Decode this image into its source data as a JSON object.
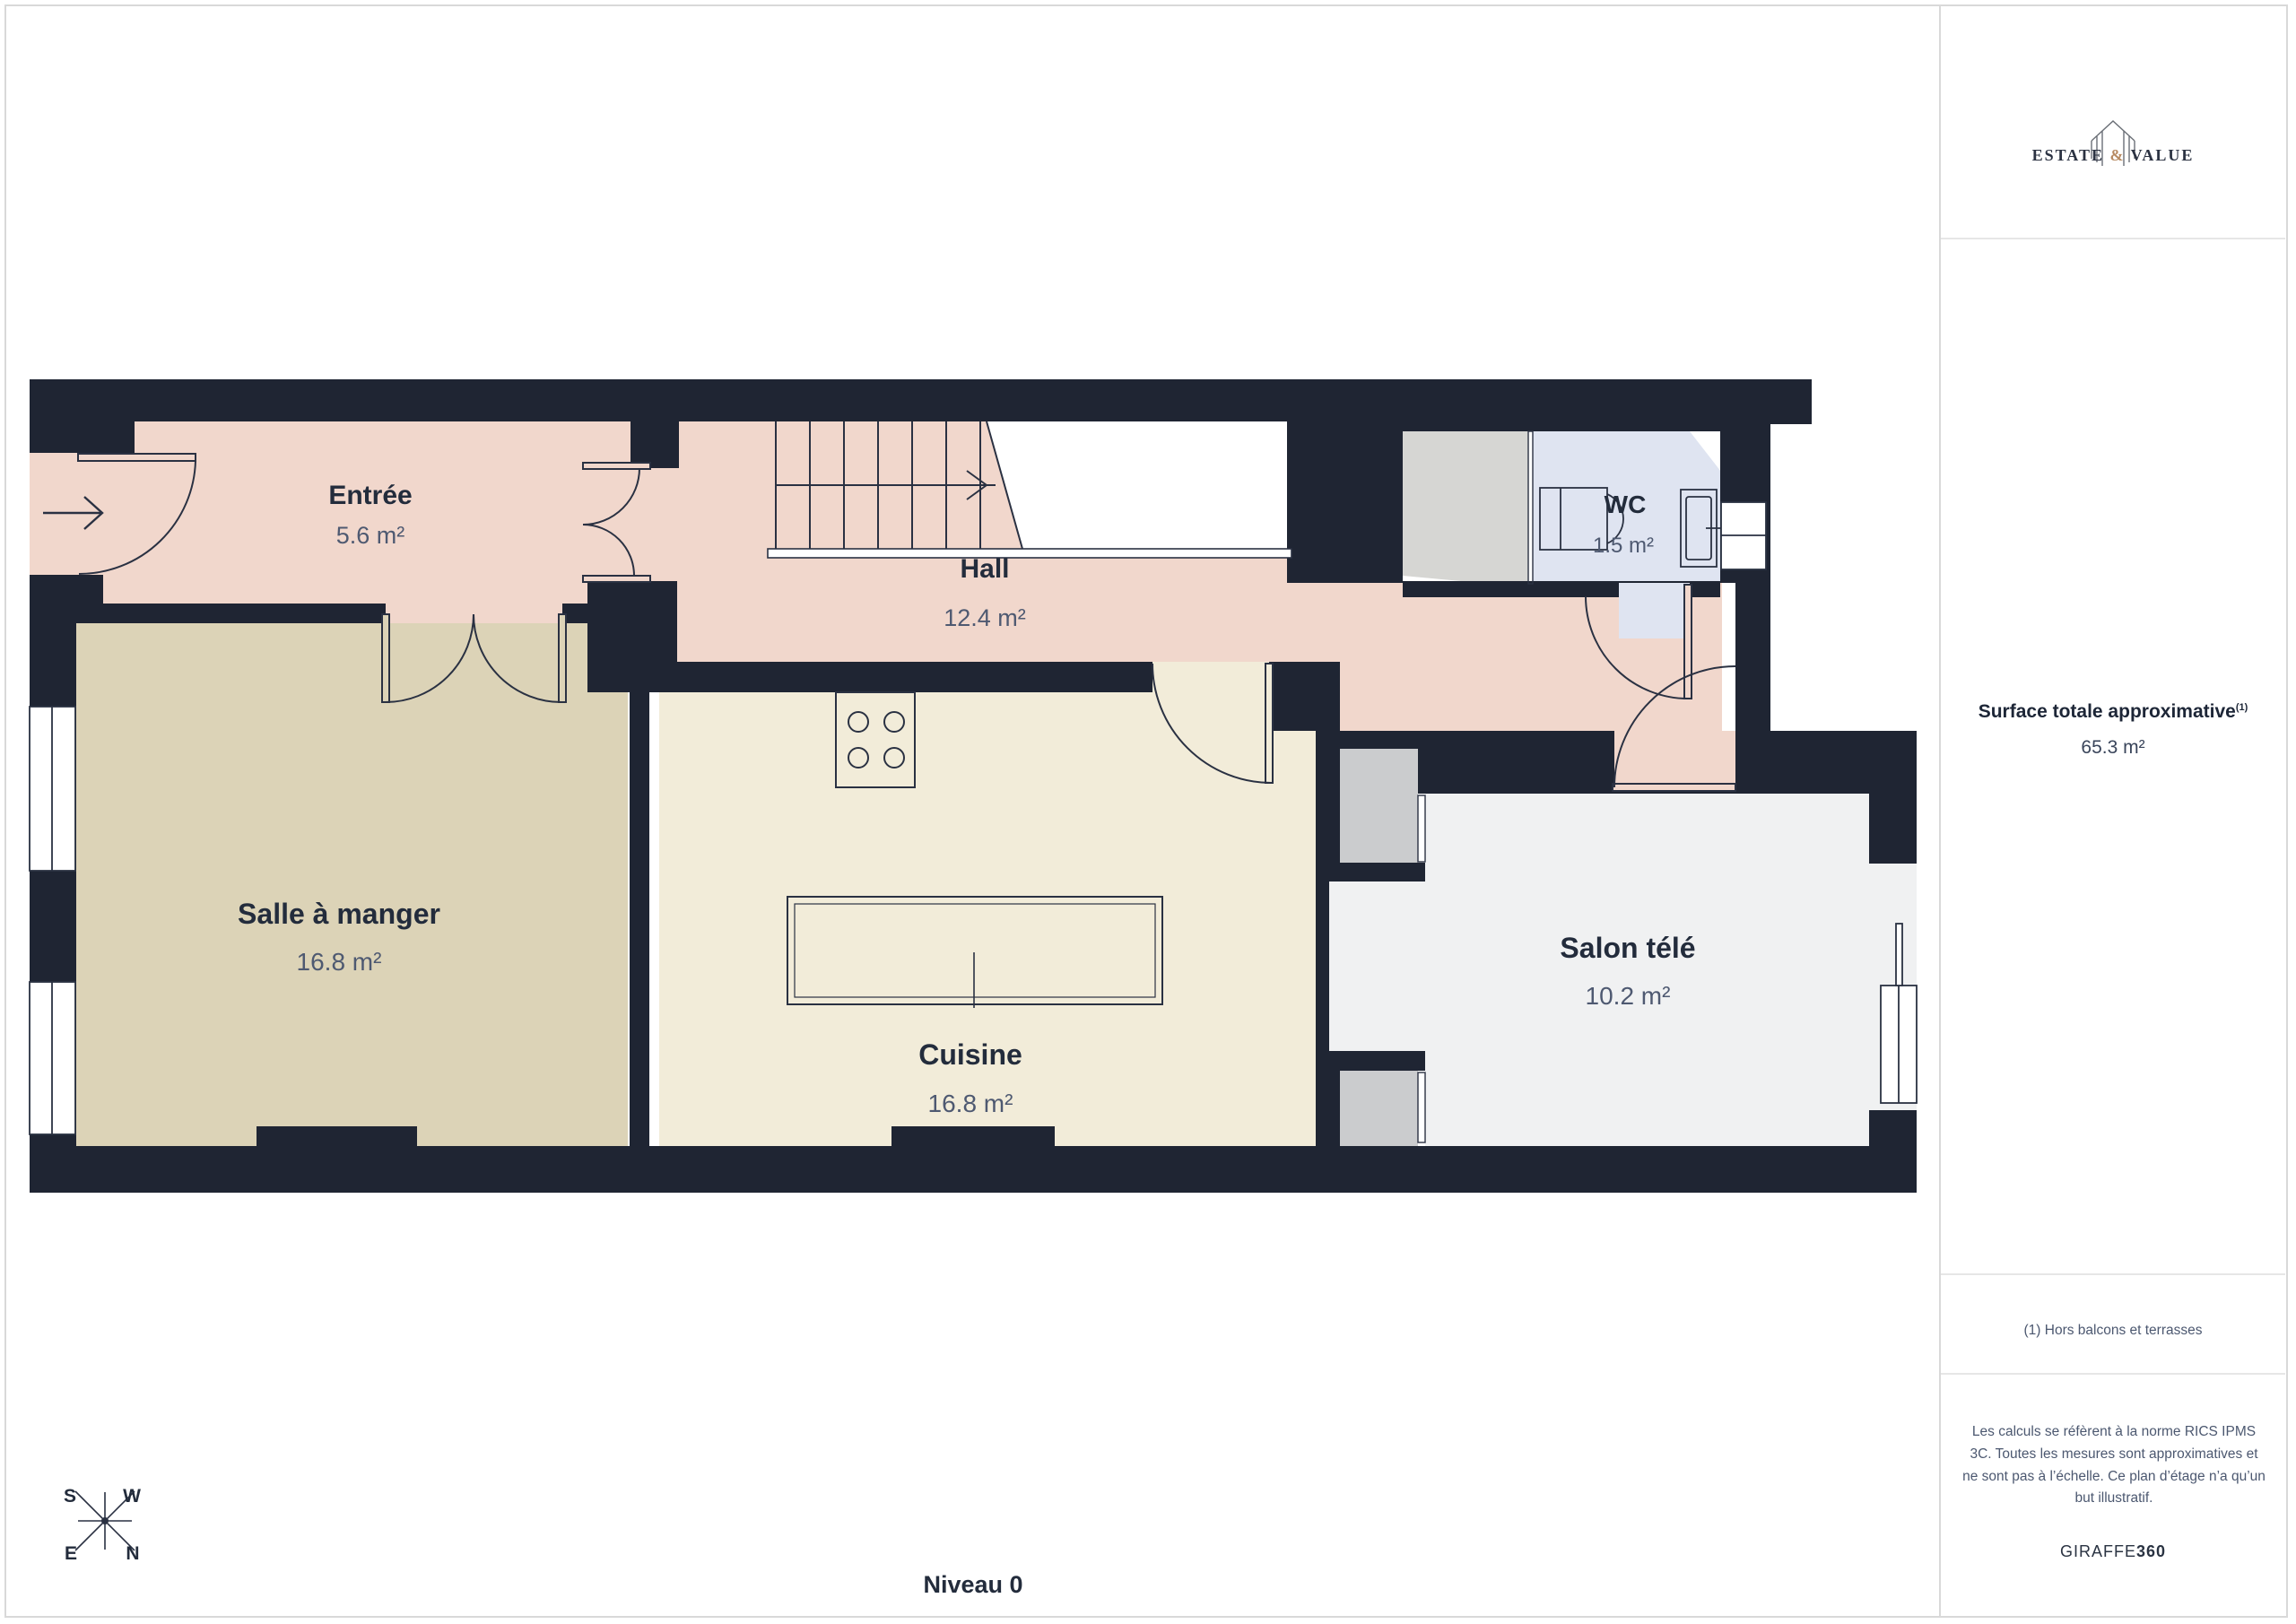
{
  "page": {
    "level_label": "Niveau 0"
  },
  "plan": {
    "rooms": [
      {
        "id": "entree",
        "name": "Entrée",
        "area": "5.6 m²"
      },
      {
        "id": "hall",
        "name": "Hall",
        "area": "12.4 m²"
      },
      {
        "id": "wc",
        "name": "WC",
        "area": "1.5 m²"
      },
      {
        "id": "salle-a-manger",
        "name": "Salle à manger",
        "area": "16.8 m²"
      },
      {
        "id": "cuisine",
        "name": "Cuisine",
        "area": "16.8 m²"
      },
      {
        "id": "salon-tele",
        "name": "Salon télé",
        "area": "10.2 m²"
      }
    ]
  },
  "compass": {
    "n": "N",
    "s": "S",
    "e": "E",
    "w": "W"
  },
  "sidebar": {
    "brand": {
      "name_left": "ESTATE",
      "amp": "&",
      "name_right": "VALUE"
    },
    "surface": {
      "title": "Surface totale approximative",
      "superscript": "(1)",
      "value": "65.3 m²"
    },
    "footnote": "(1) Hors balcons et terrasses",
    "disclaimer": "Les calculs se réfèrent à la norme RICS IPMS 3C. Toutes les mesures sont approximatives et ne sont pas à l’échelle. Ce plan d’étage n’a qu’un but illustratif.",
    "vendor": {
      "name": "GIRAFFE",
      "suffix": "360"
    }
  },
  "colors": {
    "wall": "#1f2533",
    "line": "#2a3142",
    "floor_entree_hall": "#f1d7cc",
    "floor_salle": "#dcd3b7",
    "floor_cuisine": "#f2ecd9",
    "floor_salon": "#f0f1f2",
    "floor_wc": "#dfe4f1",
    "storage_gray": "#d6d6d3",
    "appliance_gray": "#cbccce",
    "brand_accent": "#b78a62",
    "text_dark": "#232c3c",
    "text_muted": "#4e5971"
  }
}
